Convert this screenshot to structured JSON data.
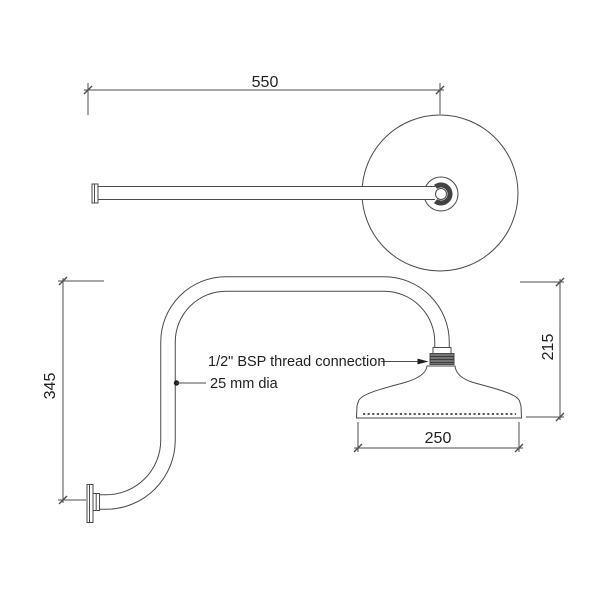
{
  "drawing": {
    "colors": {
      "line": "#4a4a4a",
      "text": "#1f1f1f",
      "thread_band": "#757575",
      "stipple": "#5a5a5a"
    },
    "dimensions": {
      "arm_length": "550",
      "wall_height": "345",
      "head_drop": "215",
      "head_diameter": "250"
    },
    "annotations": {
      "thread": "1/2\" BSP thread connection",
      "pipe": "25 mm dia"
    }
  }
}
